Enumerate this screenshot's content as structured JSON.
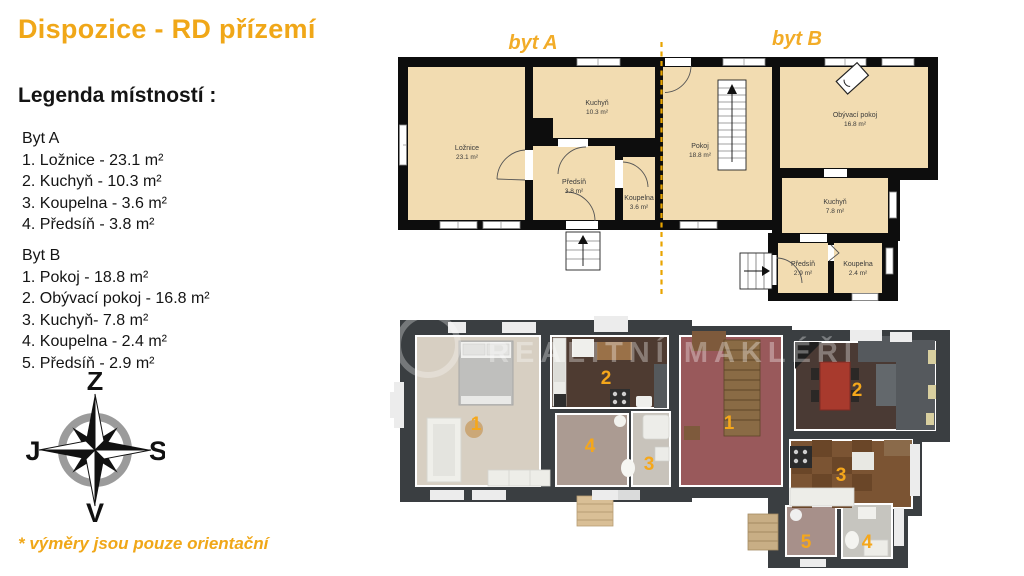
{
  "title": "Dispozice - RD přízemí",
  "legend": {
    "heading": "Legenda místností :",
    "byt_a": {
      "name": "Byt A",
      "items": [
        "1. Ložnice - 23.1 m²",
        "2. Kuchyň - 10.3 m²",
        "3. Koupelna - 3.6 m²",
        "4. Předsíň - 3.8 m²"
      ]
    },
    "byt_b": {
      "name": "Byt B",
      "items": [
        "1. Pokoj - 18.8 m²",
        "2. Obývací pokoj - 16.8 m²",
        "3. Kuchyň- 7.8 m²",
        "4. Koupelna - 2.4 m²",
        "5. Předsíň - 2.9 m²"
      ]
    }
  },
  "compass": {
    "top": "Z",
    "right": "S",
    "bottom": "V",
    "left": "J"
  },
  "footnote": "* výměry jsou pouze orientační",
  "colors": {
    "accent": "#F0A718",
    "floor_2d": "#F2DCB1",
    "wall_2d": "#0D0D0D",
    "divider": "#E8A400",
    "wall_3d": "#3A3E41",
    "number": "#F5A71B"
  },
  "plan2d": {
    "unit_a_label": "byt A",
    "unit_b_label": "byt B",
    "rooms": [
      {
        "name": "Ložnice",
        "area": "23.1 m²"
      },
      {
        "name": "Kuchyň",
        "area": "10.3 m²"
      },
      {
        "name": "Předsíň",
        "area": "3.8 m²"
      },
      {
        "name": "Koupelna",
        "area": "3.6 m²"
      },
      {
        "name": "Pokoj",
        "area": "18.8 m²"
      },
      {
        "name": "Obývací pokoj",
        "area": "16.8 m²"
      },
      {
        "name": "Kuchyň",
        "area": "7.8 m²"
      },
      {
        "name": "Předsíň",
        "area": "2.9 m²"
      },
      {
        "name": "Koupelna",
        "area": "2.4 m²"
      }
    ]
  },
  "plan3d": {
    "watermark": "REALITNÍ MAKLÉŘI",
    "numbers_a": [
      "1",
      "2",
      "3",
      "4"
    ],
    "numbers_b": [
      "1",
      "2",
      "3",
      "4",
      "5"
    ]
  }
}
